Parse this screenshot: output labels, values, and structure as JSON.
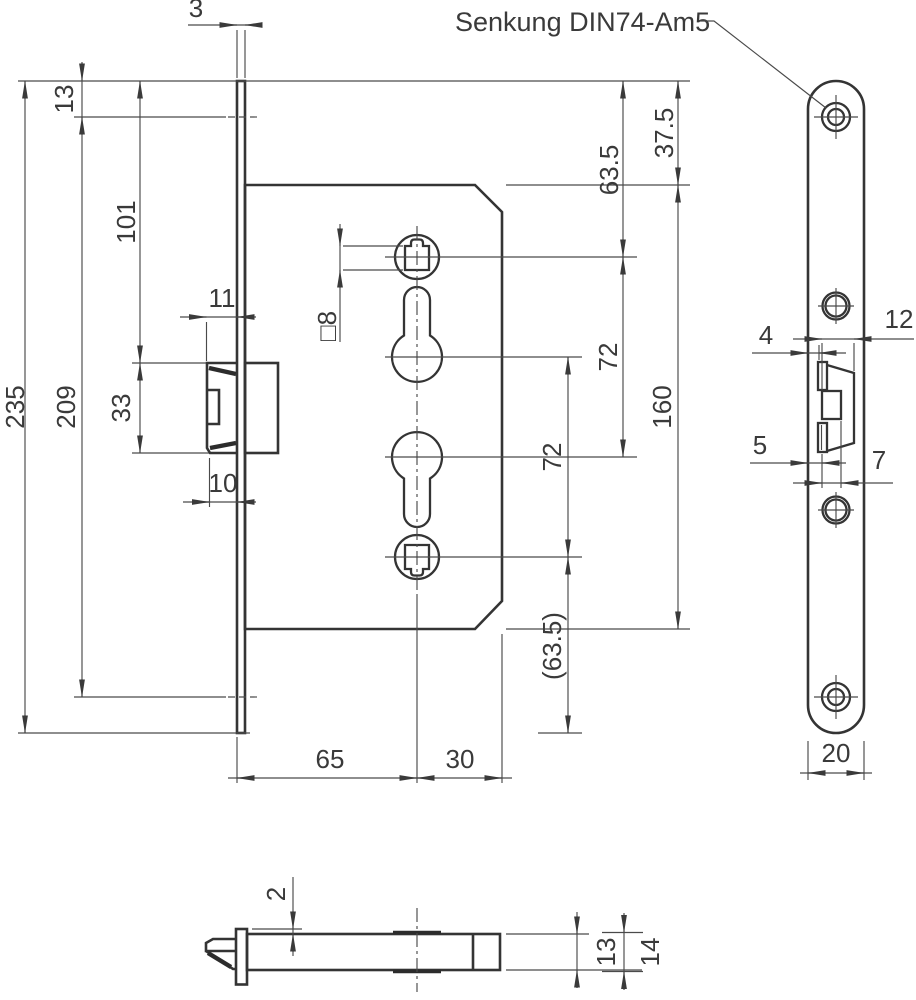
{
  "callout": {
    "senkung": "Senkung DIN74-Am5"
  },
  "front": {
    "d3": "3",
    "d13": "13",
    "d101": "101",
    "d235": "235",
    "d209": "209",
    "d33": "33",
    "d11": "11",
    "d10": "10",
    "dsq8": "□8",
    "d635": "63.5",
    "d375": "37.5",
    "d72a": "72",
    "d72b": "72",
    "d160": "160",
    "d635p": "(63.5)",
    "d65": "65",
    "d30": "30"
  },
  "plate": {
    "d4": "4",
    "d5": "5",
    "d7": "7",
    "d12": "12",
    "d20": "20"
  },
  "bottom": {
    "d2": "2",
    "d13": "13",
    "d14": "14"
  }
}
